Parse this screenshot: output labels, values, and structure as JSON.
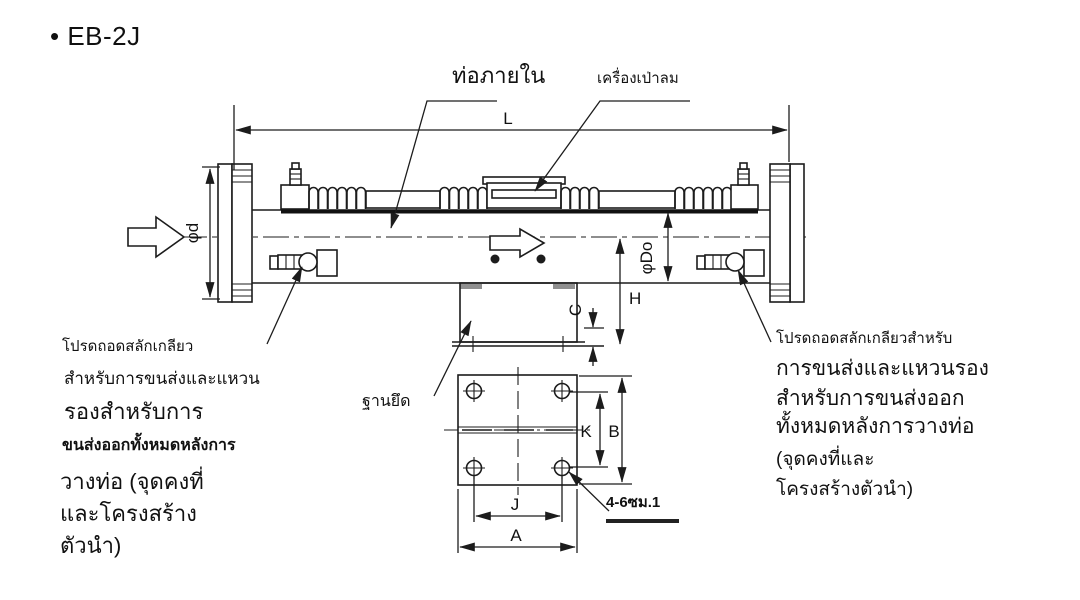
{
  "page": {
    "bullet": "•",
    "title": "EB-2J"
  },
  "labels": {
    "inner_pipe": "ท่อภายใน",
    "blower": "เครื่องเป่าลม",
    "mount_base": "ฐานยึด",
    "hole_callout": "4-6ซม.1"
  },
  "dimensions": {
    "overall_length": "L",
    "inlet_diameter": "φd",
    "outer_diameter": "φDo",
    "height": "H",
    "base_offset": "C",
    "bolt_spacing_width": "K",
    "base_width": "B",
    "bolt_spacing_length": "J",
    "base_length": "A"
  },
  "notes": {
    "left": {
      "lines": [
        "โปรดถอดสลักเกลียว",
        "สำหรับการขนส่งและแหวน",
        "รองสำหรับการ",
        "ขนส่งออกทั้งหมดหลังการ",
        "วางท่อ (จุดคงที่",
        "และโครงสร้าง",
        "ตัวนำ)"
      ]
    },
    "right": {
      "lines": [
        "โปรดถอดสลักเกลียวสำหรับ",
        "การขนส่งและแหวนรอง",
        "สำหรับการขนส่งออก",
        "ทั้งหมดหลังการวางท่อ",
        "(จุดคงที่และ",
        "โครงสร้างตัวนำ)"
      ]
    }
  },
  "colors": {
    "line": "#1c1c1c",
    "background": "#ffffff",
    "tab_gray": "#8f8f8f"
  }
}
